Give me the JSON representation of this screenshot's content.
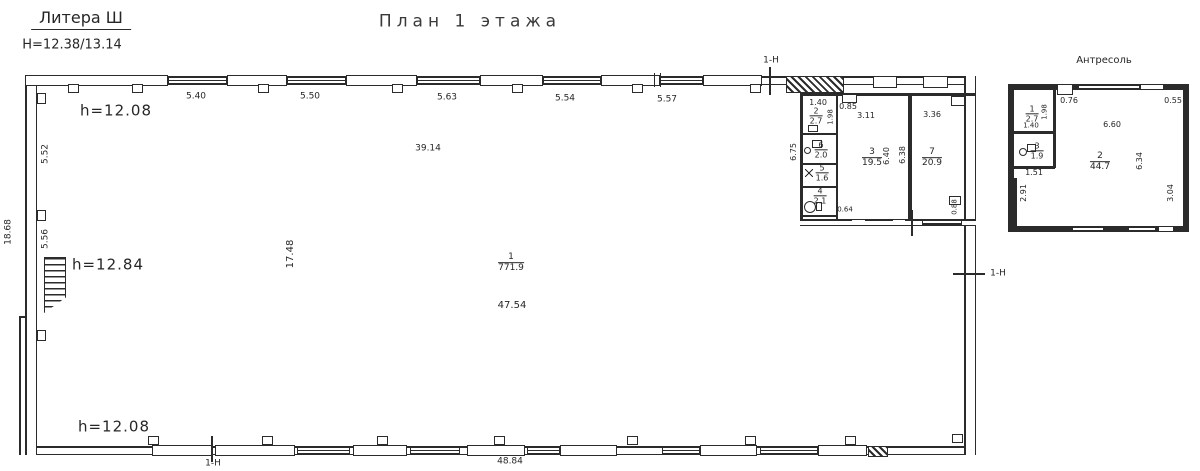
{
  "header": {
    "litera": "Литера Ш",
    "height_note": "H=12.38/13.14",
    "title": "План 1 этажа"
  },
  "main_plan": {
    "height_top": "h=12.08",
    "height_mid": "h=12.84",
    "height_bottom": "h=12.08",
    "top_dims": [
      "5.40",
      "5.50",
      "5.63",
      "5.54",
      "5.57"
    ],
    "left_outer_dim": "18.68",
    "left_dims": [
      "5.52",
      "5.56"
    ],
    "interior_width_top": "39.14",
    "interior_width_mid": "17.48",
    "hall_room_num": "1",
    "hall_room_area": "771.9",
    "interior_width_low": "47.54",
    "bottom_dim": "48.84",
    "section_marker": "1-Н"
  },
  "rooms": {
    "column_height_dim": "6.75",
    "room2": {
      "num": "2",
      "area": "2.7",
      "width": "1.40",
      "height": "1.98"
    },
    "room6": {
      "num": "6",
      "area": "2.0"
    },
    "room5": {
      "num": "5",
      "area": "1.6"
    },
    "room4": {
      "num": "4",
      "area": "2.1",
      "bottom_dim": "0.64"
    },
    "room3": {
      "num": "3",
      "area": "19.5",
      "width": "3.11",
      "height": "6.40",
      "niche_dim": "0.85"
    },
    "room7": {
      "num": "7",
      "area": "20.9",
      "width": "3.36",
      "height": "6.38",
      "side_dim": "0.88"
    }
  },
  "mezzanine": {
    "title": "Антресоль",
    "room1": {
      "num": "1",
      "area": "2.7",
      "height": "1.98",
      "width": "1.40"
    },
    "room3": {
      "num": "3",
      "area": "1.9",
      "width": "1.51"
    },
    "room2": {
      "num": "2",
      "area": "44.7",
      "top_dim": "6.60",
      "right_dim": "6.34"
    },
    "top_left_dim": "0.76",
    "top_right_dim": "0.55",
    "left_dim": "2.91",
    "right_dim": "3.04"
  }
}
